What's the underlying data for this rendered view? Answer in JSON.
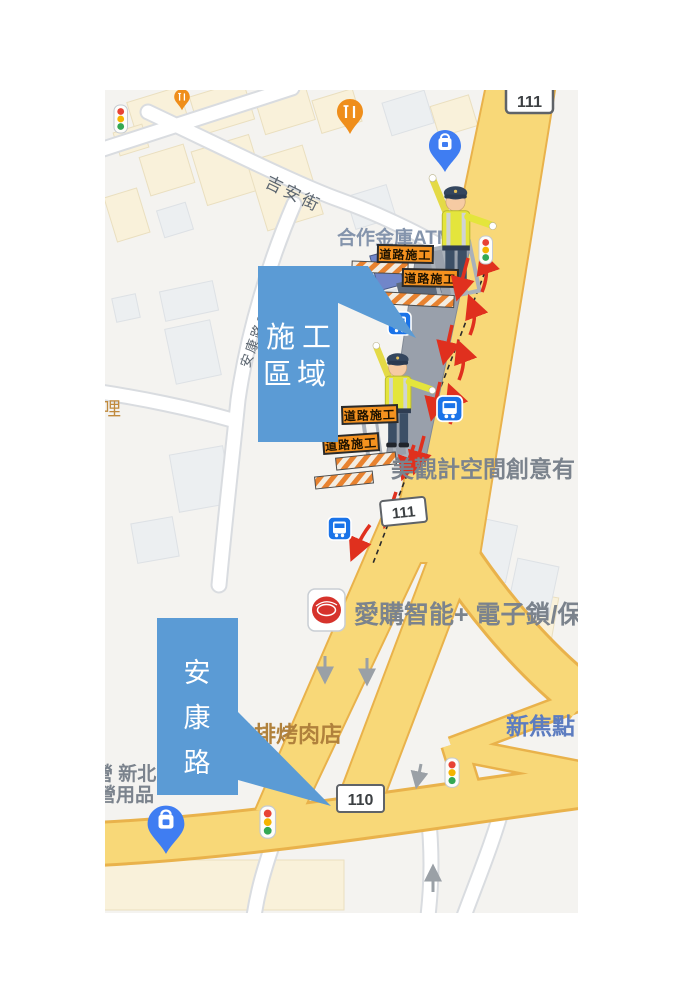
{
  "map": {
    "road_labels": {
      "jian_street": "吉安街",
      "ankang_lane": "安康路616巷"
    },
    "poi_labels": {
      "hezuo_bank_atm": "合作金庫ATM",
      "meiguan_design": "美觀計空間創意有",
      "aigou_smart": "愛購智能+ 電子鎖/保險",
      "xin_jiao_dian": "新焦點",
      "fried_chicken_bbq": "雞排烤肉店",
      "camping_store_line1": "營 新北",
      "camping_store_line2": "營用品",
      "li_partial": "哩"
    },
    "route_shields": {
      "top": "111",
      "middle": "111",
      "bottom": "110"
    },
    "construction_signs": [
      {
        "label": "道路施工"
      },
      {
        "label": "道路施工"
      },
      {
        "label": "道路施工"
      },
      {
        "label": "道路施工"
      }
    ],
    "callouts": {
      "construction_area": {
        "line1": "施工",
        "line2": "區域",
        "color": "#5b9bd5"
      },
      "ankang_road": {
        "chars": [
          "安",
          "康",
          "路"
        ],
        "color": "#5b9bd5"
      }
    },
    "colors": {
      "callout_blue": "#5b9bd5",
      "road_yellow": "#f8d878",
      "road_casing": "#e9b24b",
      "construction_gray": "#99a0ab",
      "sign_orange": "#f5921f",
      "arrow_red": "#e0301e",
      "pin_blue": "#3f7df2",
      "pin_orange": "#ef8e1b"
    }
  }
}
